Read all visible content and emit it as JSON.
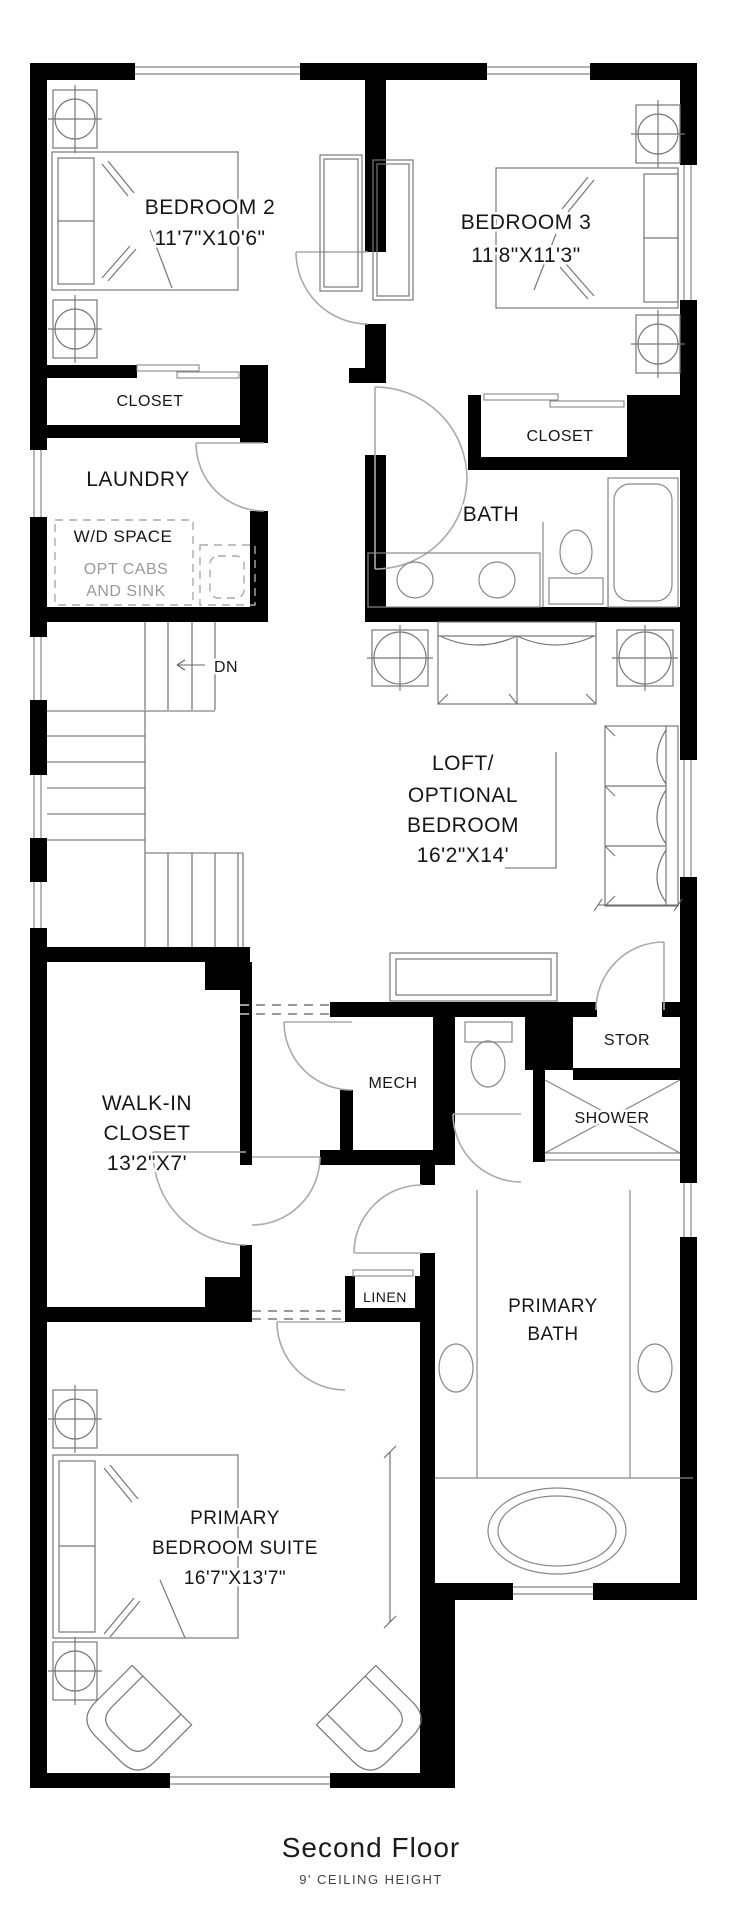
{
  "plan": {
    "rooms": {
      "bedroom2": {
        "name": "BEDROOM 2",
        "dims": "11'7\"X10'6\""
      },
      "bedroom3": {
        "name": "BEDROOM 3",
        "dims": "11'8\"X11'3\""
      },
      "closet_bedroom2": {
        "name": "CLOSET"
      },
      "closet_bedroom3": {
        "name": "CLOSET"
      },
      "laundry": {
        "name": "LAUNDRY"
      },
      "wd_space": {
        "name": "W/D SPACE",
        "note_line1": "OPT CABS",
        "note_line2": "AND SINK"
      },
      "bath": {
        "name": "BATH"
      },
      "loft": {
        "line1": "LOFT/",
        "line2": "OPTIONAL",
        "line3": "BEDROOM",
        "dims": "16'2\"X14'"
      },
      "walk_in_closet": {
        "line1": "WALK-IN",
        "line2": "CLOSET",
        "dims": "13'2\"X7'"
      },
      "mech": {
        "name": "MECH"
      },
      "stor": {
        "name": "STOR"
      },
      "shower": {
        "name": "SHOWER"
      },
      "linen": {
        "name": "LINEN"
      },
      "primary_bath": {
        "line1": "PRIMARY",
        "line2": "BATH"
      },
      "primary_bedroom": {
        "line1": "PRIMARY",
        "line2": "BEDROOM SUITE",
        "dims": "16'7\"X13'7\""
      }
    },
    "stairs": {
      "down_label": "DN"
    },
    "footer": {
      "title": "Second Floor",
      "subtitle": "9' CEILING HEIGHT"
    },
    "colors": {
      "wall": "#000000",
      "furniture_line": "#777777",
      "note_gray": "#9a9a9a"
    }
  }
}
